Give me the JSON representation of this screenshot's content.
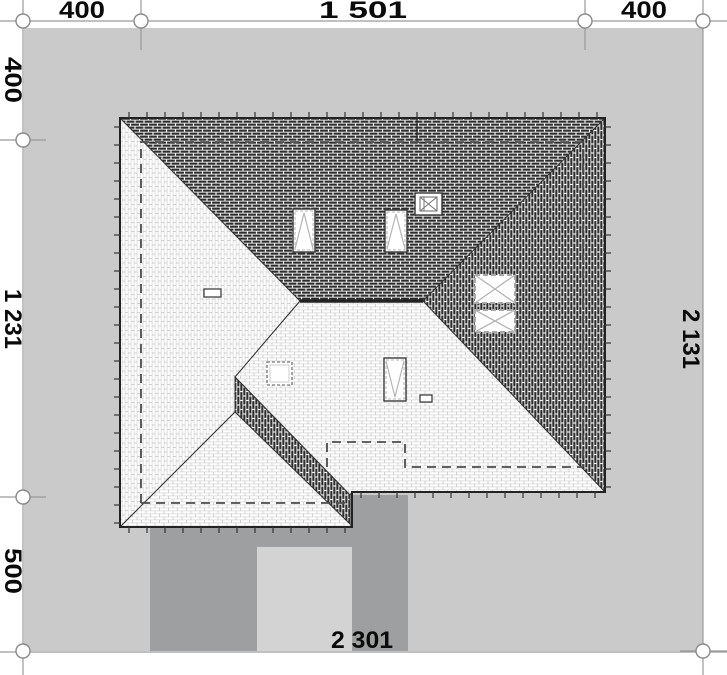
{
  "title": "House roof plan with plot dimensions",
  "dimensions": {
    "top": [
      "400",
      "1 501",
      "400"
    ],
    "left": [
      "400",
      "1 231",
      "500"
    ],
    "right": [
      "2 131"
    ],
    "bottom": [
      "2 301"
    ]
  },
  "colors": {
    "site": "#c9cac9",
    "drive": "#9d9fa0",
    "pad": "#d2d3d2",
    "white": "#ffffff",
    "dimline": "#9a9a9a",
    "roofline": "#222222",
    "dashline": "#4d4d4d",
    "ticks": "#333333",
    "symbollight": "#b5b5b5"
  },
  "plan": {
    "rects": [
      {
        "name": "site-area",
        "x": 24,
        "y": 28,
        "w": 679,
        "h": 623,
        "fill": "site"
      },
      {
        "name": "driveway-left",
        "x": 150,
        "y": 527,
        "w": 107,
        "h": 124,
        "fill": "drive"
      },
      {
        "name": "driveway-middle",
        "x": 257,
        "y": 527,
        "w": 95,
        "h": 20,
        "fill": "drive"
      },
      {
        "name": "driveway-right",
        "x": 352,
        "y": 495,
        "w": 56,
        "h": 156,
        "fill": "drive"
      },
      {
        "name": "terrace-pad",
        "x": 257,
        "y": 547,
        "w": 95,
        "h": 104,
        "fill": "pad"
      }
    ],
    "planes": [
      {
        "name": "roof-plane-north",
        "fill": "darkH",
        "points": [
          [
            120,
            118
          ],
          [
            605,
            118
          ],
          [
            423,
            301
          ],
          [
            300,
            301
          ]
        ]
      },
      {
        "name": "roof-plane-east",
        "fill": "darkV",
        "points": [
          [
            605,
            118
          ],
          [
            605,
            492
          ],
          [
            423,
            301
          ]
        ]
      },
      {
        "name": "roof-plane-west",
        "fill": "lightV",
        "points": [
          [
            120,
            118
          ],
          [
            300,
            301
          ],
          [
            235,
            377
          ],
          [
            235,
            412
          ],
          [
            120,
            527
          ]
        ]
      },
      {
        "name": "roof-plane-south",
        "fill": "lightH",
        "points": [
          [
            300,
            301
          ],
          [
            423,
            301
          ],
          [
            605,
            492
          ],
          [
            352,
            492
          ],
          [
            350,
            495
          ],
          [
            235,
            377
          ]
        ]
      },
      {
        "name": "roof-plane-valley-band",
        "fill": "darkV",
        "points": [
          [
            235,
            377
          ],
          [
            350,
            495
          ],
          [
            350,
            524
          ],
          [
            235,
            412
          ]
        ]
      },
      {
        "name": "roof-plane-garage",
        "fill": "lightH",
        "points": [
          [
            235,
            412
          ],
          [
            350,
            524
          ],
          [
            352,
            527
          ],
          [
            120,
            527
          ]
        ]
      }
    ],
    "outline": {
      "name": "roof-eave-outline",
      "points": [
        [
          120,
          118
        ],
        [
          605,
          118
        ],
        [
          605,
          492
        ],
        [
          352,
          492
        ],
        [
          352,
          527
        ],
        [
          120,
          527
        ]
      ]
    },
    "lines": [
      {
        "name": "ridge-line",
        "x1": 300,
        "y1": 301,
        "x2": 423,
        "y2": 301,
        "w": 3.5
      },
      {
        "name": "flue-line",
        "x1": 417,
        "y1": 119,
        "x2": 417,
        "y2": 142,
        "w": 1.2
      }
    ],
    "ticks": {
      "len": 6,
      "gap": 18,
      "segments": [
        {
          "x1": 120,
          "y1": 118,
          "x2": 605,
          "y2": 118,
          "nx": 0,
          "ny": -1
        },
        {
          "x1": 605,
          "y1": 118,
          "x2": 605,
          "y2": 492,
          "nx": 1,
          "ny": 0
        },
        {
          "x1": 352,
          "y1": 492,
          "x2": 605,
          "y2": 492,
          "nx": 0,
          "ny": 1
        },
        {
          "x1": 120,
          "y1": 527,
          "x2": 352,
          "y2": 527,
          "nx": 0,
          "ny": 1
        },
        {
          "x1": 120,
          "y1": 118,
          "x2": 120,
          "y2": 527,
          "nx": -1,
          "ny": 0
        }
      ]
    },
    "dashed": [
      {
        "name": "hidden-wall-outline",
        "points": [
          [
            141,
            503
          ],
          [
            141,
            142
          ],
          [
            583,
            142
          ],
          [
            583,
            467
          ]
        ]
      },
      {
        "name": "hidden-wall-garage",
        "points": [
          [
            141,
            503
          ],
          [
            345,
            503
          ]
        ]
      },
      {
        "name": "terrace-hidden-outline",
        "points": [
          [
            327,
            467
          ],
          [
            327,
            442
          ],
          [
            405,
            442
          ],
          [
            405,
            467
          ],
          [
            583,
            467
          ]
        ]
      }
    ],
    "symbols": [
      {
        "type": "window-up",
        "name": "roof-window-1",
        "x": 293,
        "y": 209,
        "w": 22,
        "h": 43
      },
      {
        "type": "window-up",
        "name": "roof-window-2",
        "x": 385,
        "y": 210,
        "w": 22,
        "h": 42
      },
      {
        "type": "window-down",
        "name": "roof-window-3",
        "x": 384,
        "y": 358,
        "w": 22,
        "h": 43
      },
      {
        "type": "skylight",
        "name": "flat-skylight",
        "x": 267,
        "y": 362,
        "w": 25,
        "h": 23
      },
      {
        "type": "chimney",
        "name": "chimney",
        "x": 415,
        "y": 193,
        "w": 27,
        "h": 22
      },
      {
        "type": "hatch-x",
        "name": "roof-hatch-1",
        "x": 475,
        "y": 275,
        "w": 40,
        "h": 28
      },
      {
        "type": "hatch-x",
        "name": "roof-hatch-2",
        "x": 475,
        "y": 310,
        "w": 40,
        "h": 22
      },
      {
        "type": "vent",
        "name": "roof-vent-1",
        "x": 204,
        "y": 289,
        "w": 17,
        "h": 8
      },
      {
        "type": "vent",
        "name": "roof-vent-2",
        "x": 420,
        "y": 395,
        "w": 12,
        "h": 7
      }
    ],
    "dim_lines": [
      {
        "name": "dim-line-top",
        "x1": 0,
        "y1": 21,
        "x2": 727,
        "y2": 21
      },
      {
        "name": "dim-line-left",
        "x1": 23,
        "y1": 0,
        "x2": 23,
        "y2": 675
      },
      {
        "name": "dim-line-right",
        "x1": 703,
        "y1": 0,
        "x2": 703,
        "y2": 675
      },
      {
        "name": "dim-line-bottom",
        "x1": 0,
        "y1": 652,
        "x2": 727,
        "y2": 652
      },
      {
        "name": "ext-top-1",
        "x1": 141,
        "y1": 0,
        "x2": 141,
        "y2": 50
      },
      {
        "name": "ext-top-2",
        "x1": 585,
        "y1": 0,
        "x2": 585,
        "y2": 50
      },
      {
        "name": "ext-left-1",
        "x1": 0,
        "y1": 140,
        "x2": 46,
        "y2": 140
      },
      {
        "name": "ext-left-2",
        "x1": 0,
        "y1": 497,
        "x2": 46,
        "y2": 497
      },
      {
        "name": "ext-right-1",
        "x1": 680,
        "y1": 651,
        "x2": 727,
        "y2": 651
      }
    ],
    "markers": [
      {
        "cx": 23,
        "cy": 21
      },
      {
        "cx": 141,
        "cy": 21
      },
      {
        "cx": 585,
        "cy": 21
      },
      {
        "cx": 703,
        "cy": 21
      },
      {
        "cx": 23,
        "cy": 140
      },
      {
        "cx": 23,
        "cy": 497
      },
      {
        "cx": 23,
        "cy": 651
      },
      {
        "cx": 703,
        "cy": 651
      }
    ]
  }
}
